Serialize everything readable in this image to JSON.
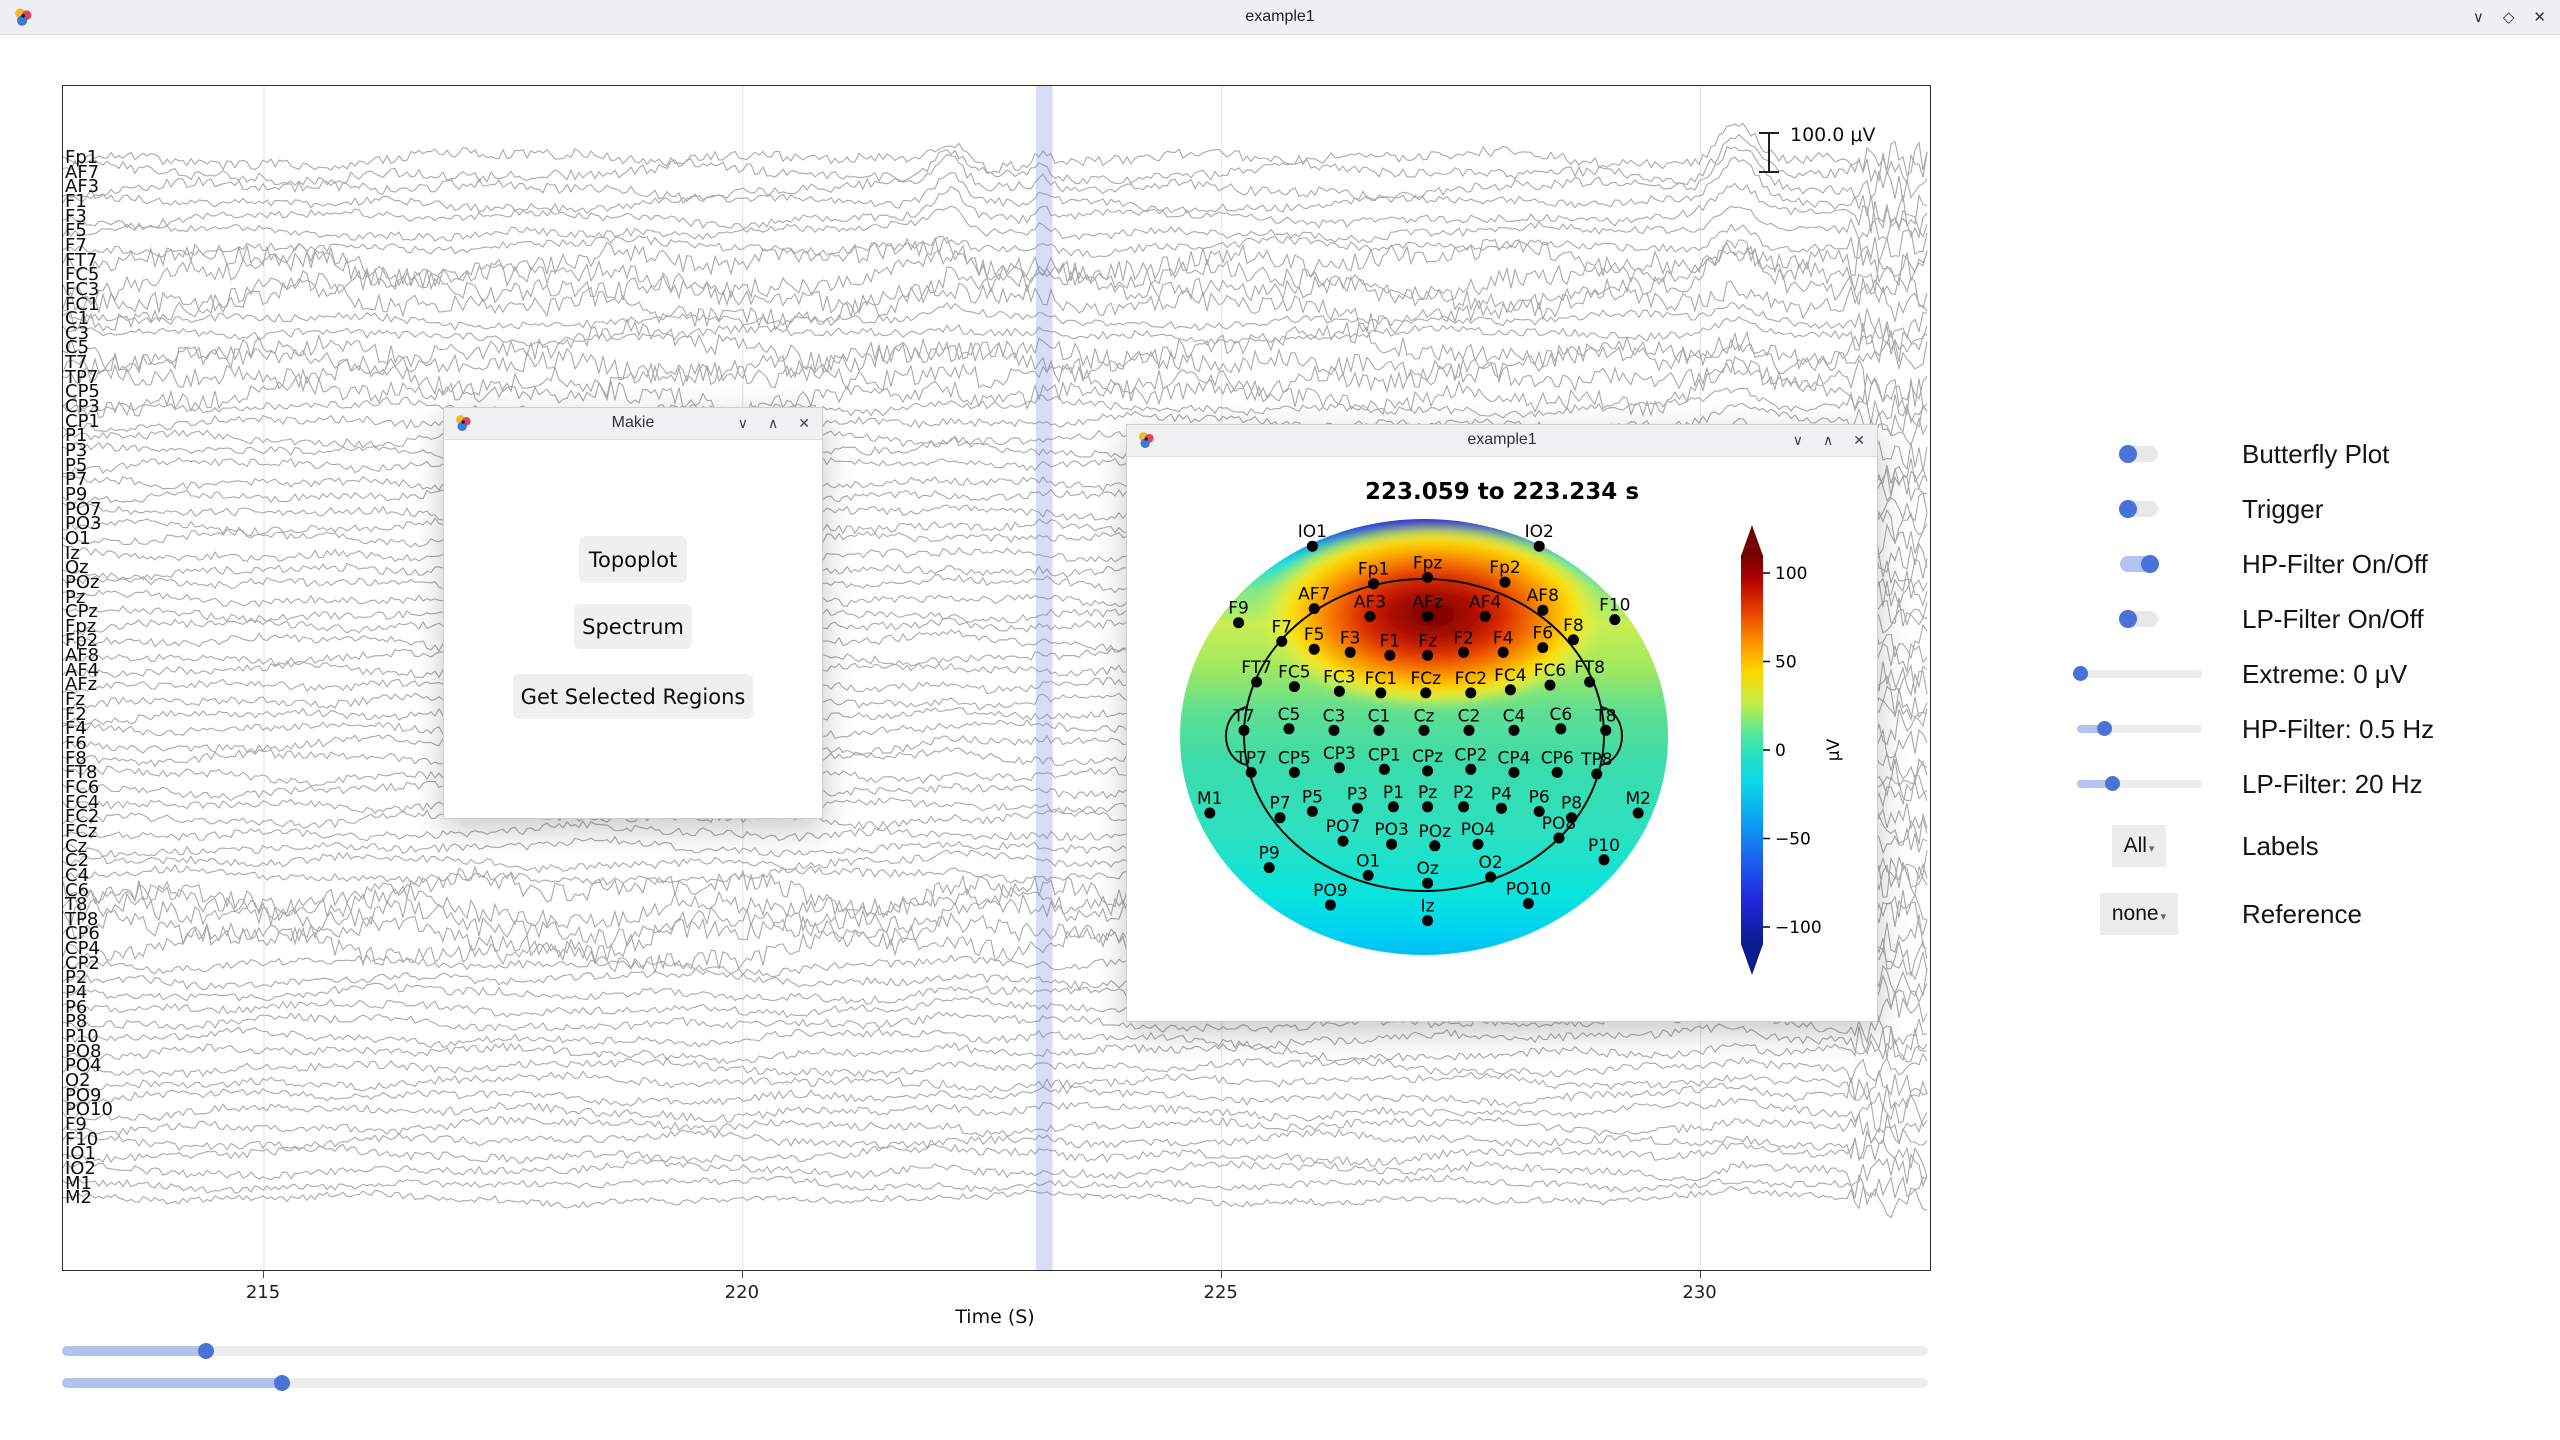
{
  "app": {
    "title": "example1",
    "controls": [
      "∨",
      "◇",
      "✕"
    ]
  },
  "main_plot": {
    "channels": [
      "Fp1",
      "AF7",
      "AF3",
      "F1",
      "F3",
      "F5",
      "F7",
      "FT7",
      "FC5",
      "FC3",
      "FC1",
      "C1",
      "C3",
      "C5",
      "T7",
      "TP7",
      "CP5",
      "CP3",
      "CP1",
      "P1",
      "P3",
      "P5",
      "P7",
      "P9",
      "PO7",
      "PO3",
      "O1",
      "Iz",
      "Oz",
      "POz",
      "Pz",
      "CPz",
      "Fpz",
      "Fp2",
      "AF8",
      "AF4",
      "AFz",
      "Fz",
      "F2",
      "F4",
      "F6",
      "F8",
      "FT8",
      "FC6",
      "FC4",
      "FC2",
      "FCz",
      "Cz",
      "C2",
      "C4",
      "C6",
      "T8",
      "TP8",
      "CP6",
      "CP4",
      "CP2",
      "P2",
      "P4",
      "P6",
      "P8",
      "P10",
      "PO8",
      "PO4",
      "O2",
      "PO9",
      "PO10",
      "F9",
      "F10",
      "IO1",
      "IO2",
      "M1",
      "M2"
    ],
    "time_axis": {
      "ticks": [
        215,
        220,
        225,
        230
      ],
      "label": "Time (S)"
    },
    "scale_label": "100.0 μV",
    "selection": {
      "start_s": 223.059,
      "end_s": 223.234
    },
    "trace_color": "#a9a9ab",
    "selection_color": "rgba(116,130,214,0.28)"
  },
  "makie_window": {
    "title": "Makie",
    "controls": [
      "∨",
      "∧",
      "✕"
    ],
    "buttons": [
      "Topoplot",
      "Spectrum",
      "Get Selected Regions"
    ]
  },
  "topo_window": {
    "title": "example1",
    "controls": [
      "∨",
      "∧",
      "✕"
    ],
    "heading": "223.059 to 223.234 s",
    "colorbar": {
      "values": [
        100,
        50,
        0,
        -50,
        -100
      ],
      "labels": [
        "100",
        "50",
        "0",
        "−50",
        "−100"
      ],
      "label": "μV"
    },
    "electrodes": [
      [
        "IO1",
        -0.62,
        1.21
      ],
      [
        "IO2",
        0.64,
        1.21
      ],
      [
        "Fp1",
        -0.28,
        0.97
      ],
      [
        "Fpz",
        0.02,
        1.01
      ],
      [
        "Fp2",
        0.45,
        0.98
      ],
      [
        "AF7",
        -0.61,
        0.81
      ],
      [
        "AF3",
        -0.3,
        0.76
      ],
      [
        "AFz",
        0.02,
        0.76
      ],
      [
        "AF4",
        0.34,
        0.76
      ],
      [
        "AF8",
        0.66,
        0.8
      ],
      [
        "F9",
        -1.03,
        0.72
      ],
      [
        "F10",
        1.06,
        0.74
      ],
      [
        "F7",
        -0.79,
        0.6
      ],
      [
        "F5",
        -0.61,
        0.55
      ],
      [
        "F3",
        -0.41,
        0.53
      ],
      [
        "F1",
        -0.19,
        0.51
      ],
      [
        "Fz",
        0.02,
        0.51
      ],
      [
        "F2",
        0.22,
        0.53
      ],
      [
        "F4",
        0.44,
        0.53
      ],
      [
        "F6",
        0.66,
        0.56
      ],
      [
        "F8",
        0.83,
        0.61
      ],
      [
        "FT7",
        -0.93,
        0.34
      ],
      [
        "FC5",
        -0.72,
        0.31
      ],
      [
        "FC3",
        -0.47,
        0.28
      ],
      [
        "FC1",
        -0.24,
        0.27
      ],
      [
        "FCz",
        0.01,
        0.27
      ],
      [
        "FC2",
        0.26,
        0.27
      ],
      [
        "FC4",
        0.48,
        0.29
      ],
      [
        "FC6",
        0.7,
        0.32
      ],
      [
        "FT8",
        0.92,
        0.34
      ],
      [
        "T7",
        -1.0,
        0.03
      ],
      [
        "C5",
        -0.75,
        0.04
      ],
      [
        "C3",
        -0.5,
        0.03
      ],
      [
        "C1",
        -0.25,
        0.03
      ],
      [
        "Cz",
        0.0,
        0.03
      ],
      [
        "C2",
        0.25,
        0.03
      ],
      [
        "C4",
        0.5,
        0.03
      ],
      [
        "C6",
        0.76,
        0.04
      ],
      [
        "T8",
        1.01,
        0.03
      ],
      [
        "TP7",
        -0.96,
        -0.24
      ],
      [
        "CP5",
        -0.72,
        -0.24
      ],
      [
        "CP3",
        -0.47,
        -0.21
      ],
      [
        "CP1",
        -0.22,
        -0.22
      ],
      [
        "CPz",
        0.02,
        -0.23
      ],
      [
        "CP2",
        0.26,
        -0.22
      ],
      [
        "CP4",
        0.5,
        -0.24
      ],
      [
        "CP6",
        0.74,
        -0.24
      ],
      [
        "TP8",
        0.96,
        -0.25
      ],
      [
        "M1",
        -1.19,
        -0.5
      ],
      [
        "M2",
        1.19,
        -0.5
      ],
      [
        "P7",
        -0.8,
        -0.53
      ],
      [
        "P5",
        -0.62,
        -0.49
      ],
      [
        "P3",
        -0.37,
        -0.47
      ],
      [
        "P1",
        -0.17,
        -0.46
      ],
      [
        "Pz",
        0.02,
        -0.46
      ],
      [
        "P2",
        0.22,
        -0.46
      ],
      [
        "P4",
        0.43,
        -0.47
      ],
      [
        "P6",
        0.64,
        -0.49
      ],
      [
        "P8",
        0.82,
        -0.53
      ],
      [
        "P9",
        -0.86,
        -0.85
      ],
      [
        "P10",
        1.0,
        -0.8
      ],
      [
        "PO7",
        -0.45,
        -0.68
      ],
      [
        "PO3",
        -0.18,
        -0.7
      ],
      [
        "POz",
        0.06,
        -0.71
      ],
      [
        "PO4",
        0.3,
        -0.7
      ],
      [
        "PO8",
        0.75,
        -0.66
      ],
      [
        "O1",
        -0.31,
        -0.9
      ],
      [
        "Oz",
        0.02,
        -0.95
      ],
      [
        "O2",
        0.37,
        -0.91
      ],
      [
        "PO9",
        -0.52,
        -1.09
      ],
      [
        "Iz",
        0.02,
        -1.19
      ],
      [
        "PO10",
        0.58,
        -1.08
      ]
    ]
  },
  "side_controls": [
    {
      "type": "toggle",
      "label": "Butterfly Plot",
      "on": false
    },
    {
      "type": "toggle",
      "label": "Trigger",
      "on": false
    },
    {
      "type": "toggle",
      "label": "HP-Filter On/Off",
      "on": true
    },
    {
      "type": "toggle",
      "label": "LP-Filter On/Off",
      "on": false
    },
    {
      "type": "slider",
      "label": "Extreme: 0 μV",
      "fraction": 0.03
    },
    {
      "type": "slider",
      "label": "HP-Filter: 0.5 Hz",
      "fraction": 0.22
    },
    {
      "type": "slider",
      "label": "LP-Filter: 20 Hz",
      "fraction": 0.28
    },
    {
      "type": "menu",
      "label": "Labels",
      "value": "All"
    },
    {
      "type": "menu",
      "label": "Reference",
      "value": "none"
    }
  ],
  "bottom_sliders": [
    {
      "fraction": 0.077
    },
    {
      "fraction": 0.118
    }
  ],
  "colors": {
    "accent": "#4a72d8",
    "accent_light": "#b3c5ee",
    "track": "#ececec"
  }
}
